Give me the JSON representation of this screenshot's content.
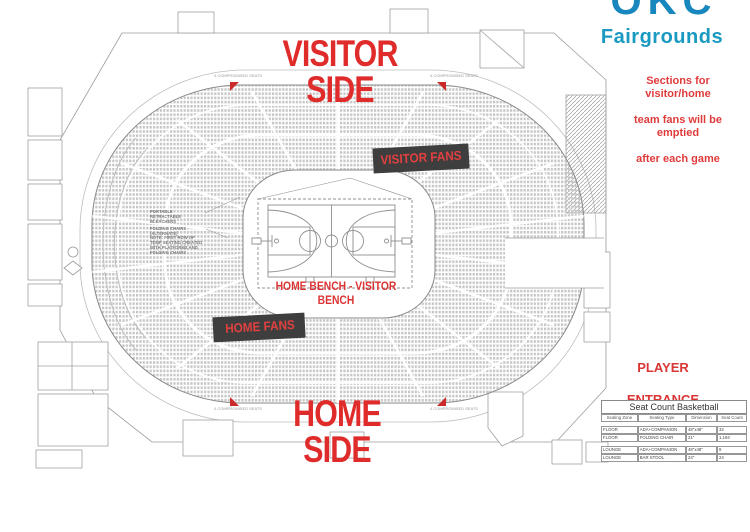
{
  "titles": {
    "visitor_side": "VISITOR SIDE",
    "home_side": "HOME SIDE"
  },
  "labels": {
    "visitor_fans": "VISITOR FANS",
    "home_fans": "HOME FANS",
    "bench": "HOME BENCH - VISITOR BENCH",
    "player_entrance_line1": "PLAYER",
    "player_entrance_line2": "ENTRANCE"
  },
  "logo": {
    "brand_top": "OKC",
    "brand_bottom": "Fairgrounds"
  },
  "notice": {
    "line1": "Sections for visitor/home",
    "line2": "team fans will be emptied",
    "line3": "after each game"
  },
  "annotations": {
    "portable": "PORTABLE RETRACTABLE BLEACHERS",
    "folding": "FOLDING CHAIRS (ALTERNATE)",
    "note": "NOTE: FIRST ROW OF TEMP SEATING CREATED WITH PLATFORMS AND FOLDING CHAIRS",
    "compromised": "4 COMPROMISED SEATS"
  },
  "seat_table": {
    "title": "Seat Count Basketball",
    "headers": [
      "Seating Zone",
      "Seating Type",
      "Dimension",
      "Seat Count"
    ],
    "rows": [
      {
        "zone": "FLOOR",
        "type": "ADA+COMPANION",
        "dim": "48\"x48\"",
        "count": "32"
      },
      {
        "zone": "FLOOR",
        "type": "FOLDING CHAIR",
        "dim": "21\"",
        "count": "1,194"
      },
      {
        "zone": "LOUNGE",
        "type": "ADA+COMPANION",
        "dim": "48\"x48\"",
        "count": "8"
      },
      {
        "zone": "LOUNGE",
        "type": "BAR STOOL",
        "dim": "24\"",
        "count": "24"
      }
    ]
  },
  "colors": {
    "accent_red": "#e02b2b",
    "brand_teal": "#1a9ac1",
    "seat_grey": "#c6c6c6",
    "line_grey": "#8f8f8f",
    "fan_block_dark": "#3f3e3e"
  }
}
